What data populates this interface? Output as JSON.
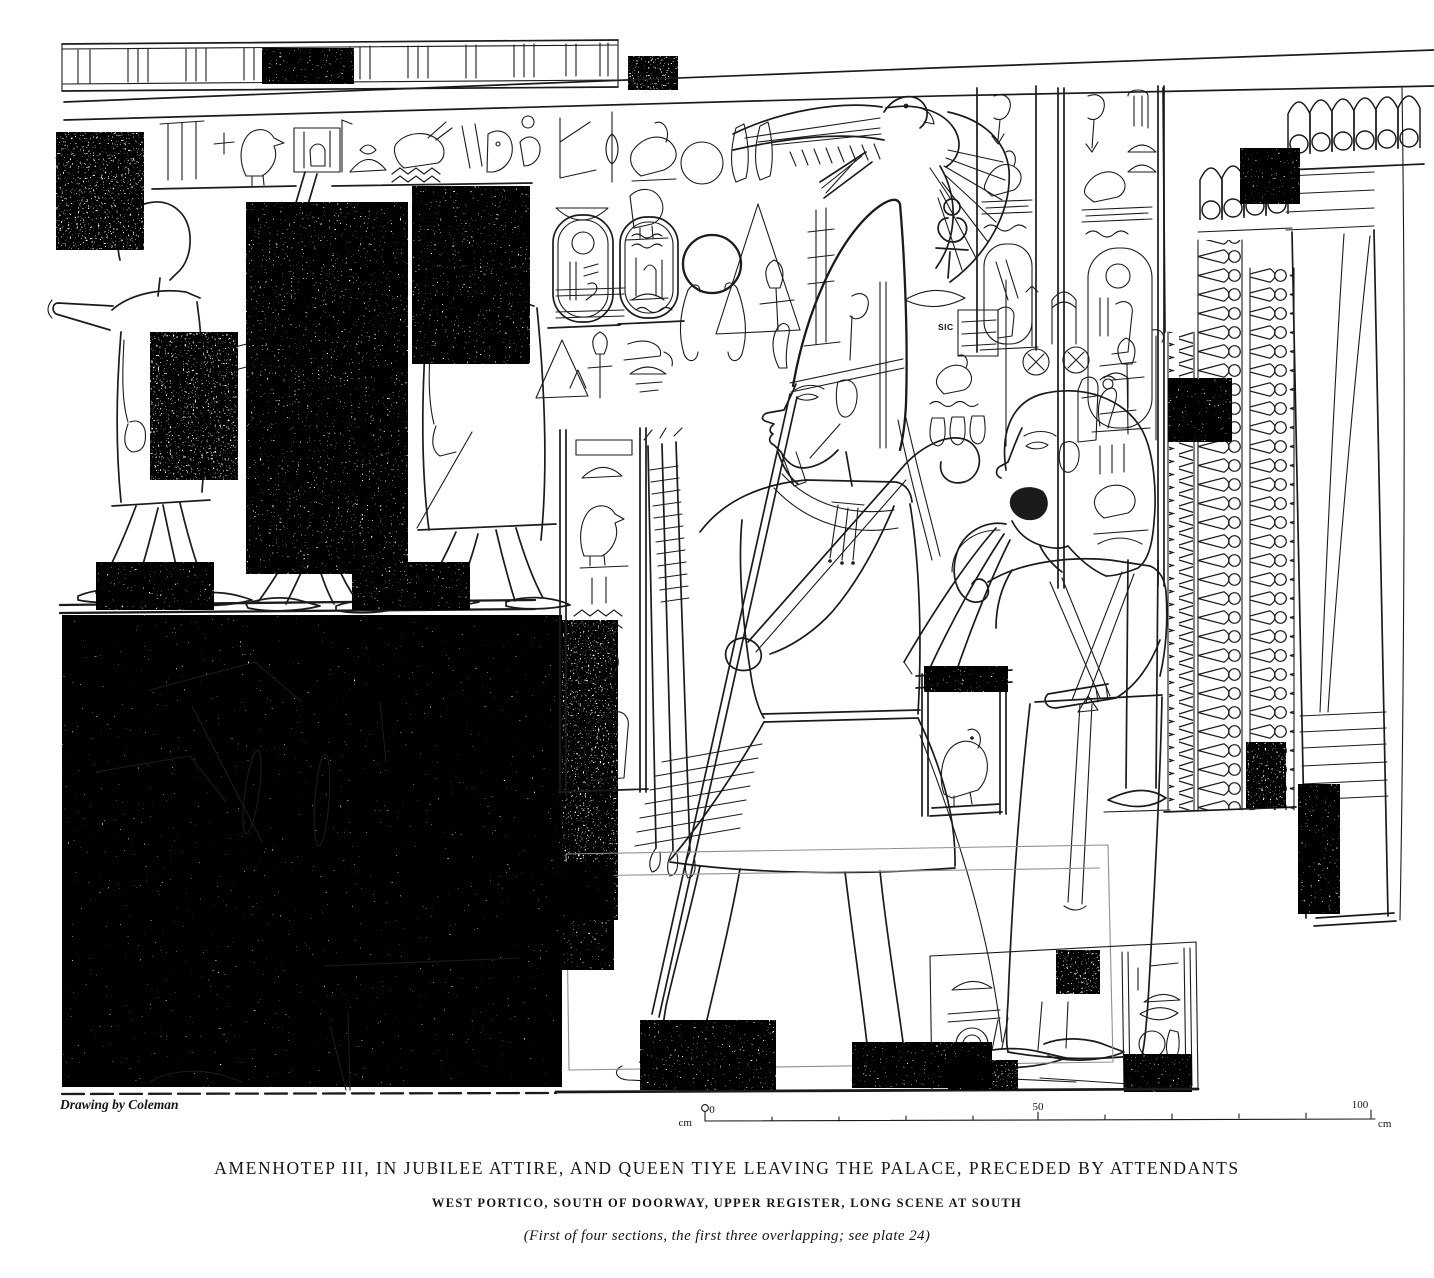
{
  "plate": {
    "caption": {
      "title": "AMENHOTEP III, IN JUBILEE ATTIRE, AND QUEEN TIYE LEAVING THE PALACE, PRECEDED BY ATTENDANTS",
      "subtitle": "WEST PORTICO, SOUTH OF DOORWAY, UPPER REGISTER, LONG SCENE AT SOUTH",
      "note": "(First of four sections, the first three overlapping; see plate 24)"
    },
    "credit": "Drawing by Coleman",
    "annotations": {
      "sic": "SIC"
    },
    "scale_bar": {
      "unit_left": "cm",
      "start": "0",
      "middle": "50",
      "end": "100",
      "unit_right": "cm"
    },
    "colors": {
      "ink": "#1b1b1b",
      "paper": "#ffffff"
    }
  }
}
